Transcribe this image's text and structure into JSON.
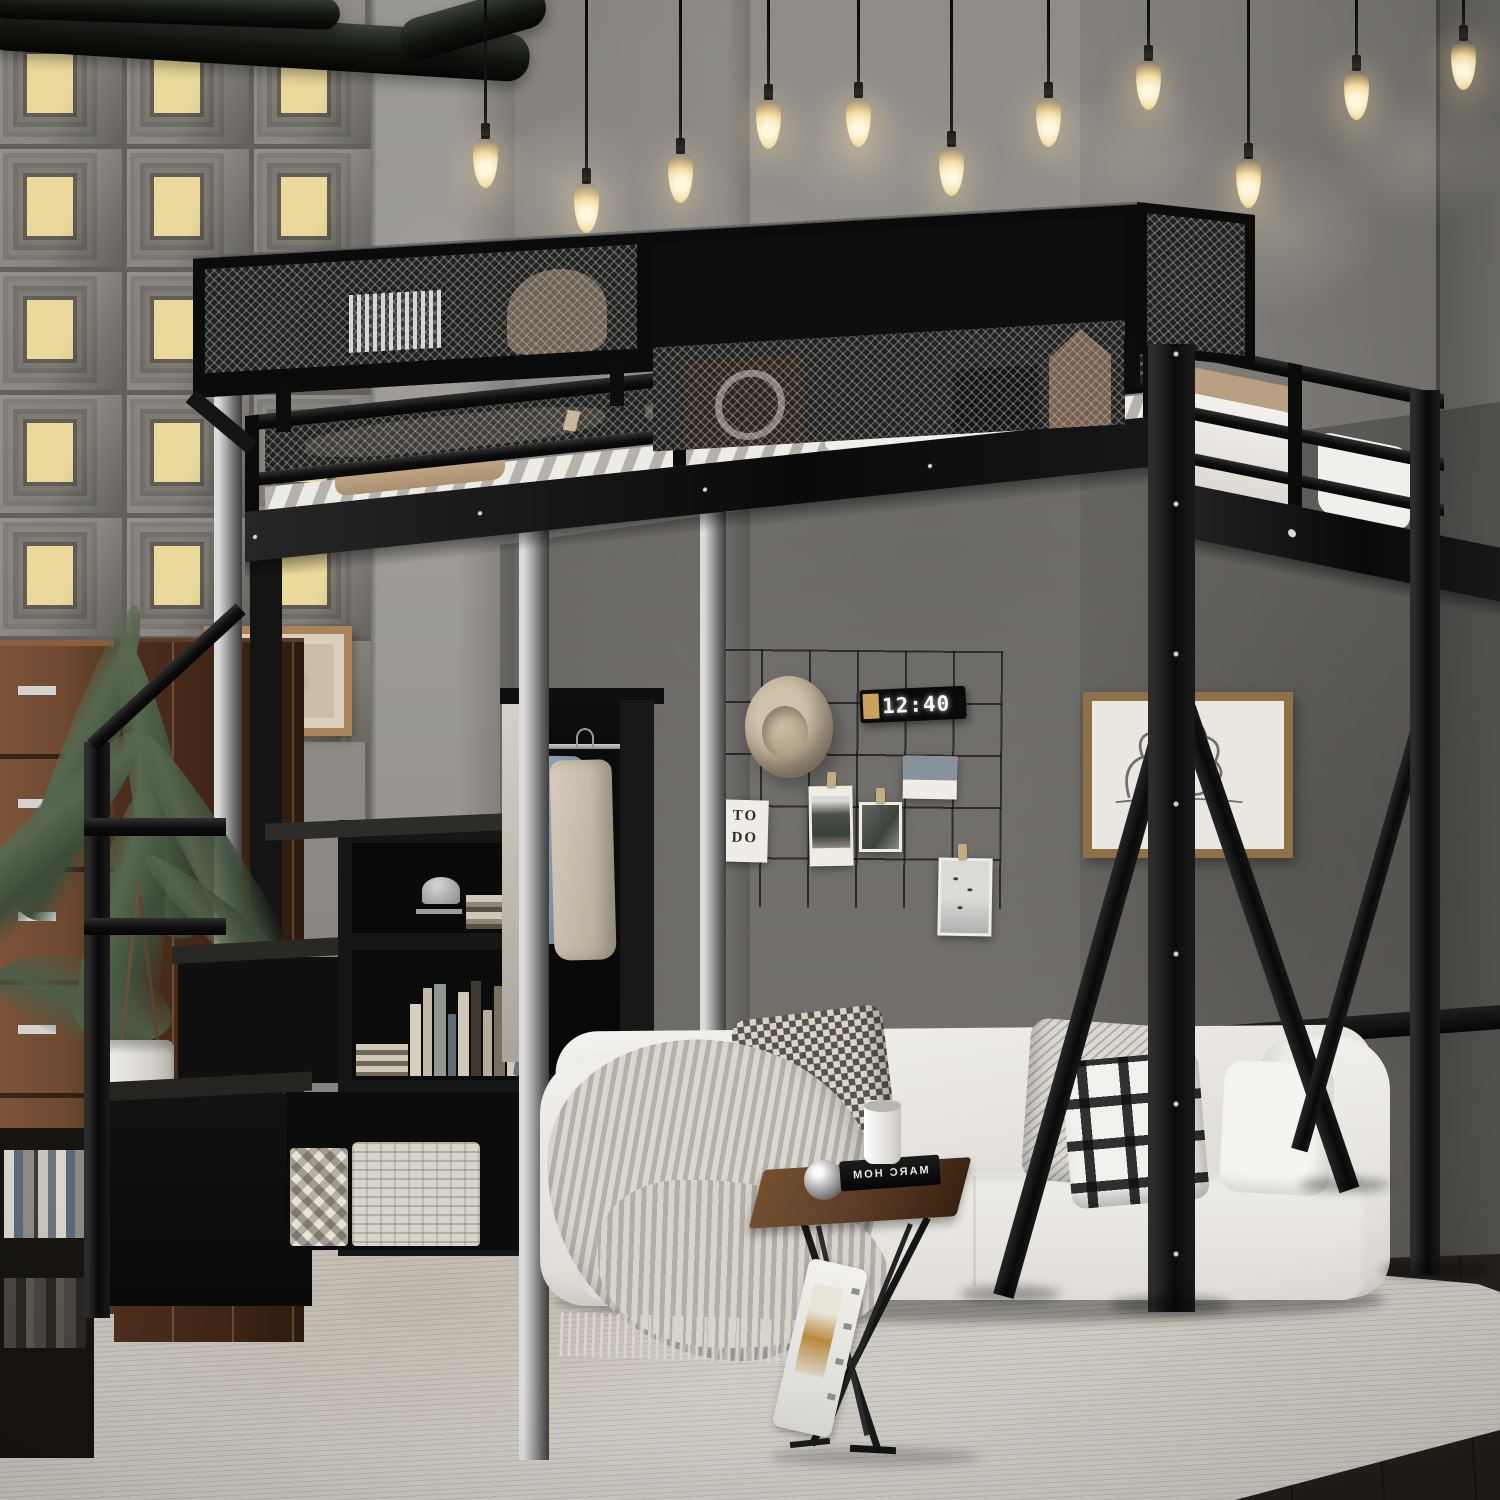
{
  "scene": {
    "type": "product-photograph",
    "subject": "black metal twin loft bed with storage staircase, bookshelf shelves, hanging-clothes rod and overhead mesh storage shelf",
    "room_style": "industrial loft bedroom: concrete walls, backlit relief tile wall, ceiling pipes, pendant Edison bulbs, white sofa on a pale rug",
    "pendant_bulb_count": 11
  },
  "wall_decor": {
    "clock_time": "12:40",
    "todo_card_line1": "TO",
    "todo_card_line2": "DO",
    "grid_photo_count": 4,
    "hat_style": "tan fedora hat"
  },
  "side_table": {
    "book_title": "MARC HOM"
  },
  "colors": {
    "metal": "#111111",
    "silver": "#b5b5b5",
    "concrete": "#908d88",
    "concrete_dark": "#716e69",
    "tile_window": "#ead99b",
    "mattress": "#f3f1ed",
    "sofa": "#ecebe6",
    "rug": "#d7d3cd",
    "floor": "#2e2a25",
    "wood_dresser": "#6f4a31",
    "wood_cabinet": "#3f2517",
    "wood_table": "#5f3f2a",
    "bulb_glow": "#f4dfa6",
    "plant": "#57684f",
    "hat": "#c0b098",
    "paper": "#f0ede7",
    "clock_digits": "#f5f5f5",
    "gold": "#c9a458",
    "blanket": "#b6b2ab"
  }
}
